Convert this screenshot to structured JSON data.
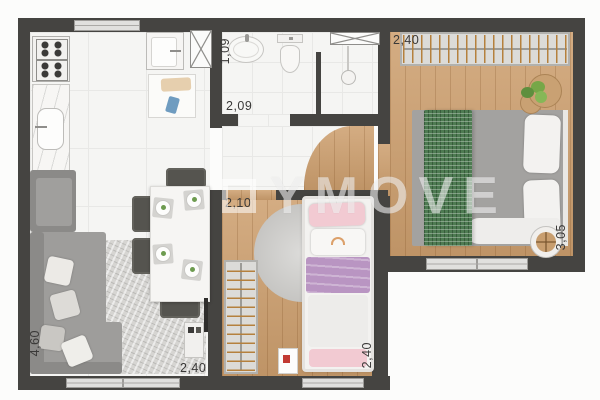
{
  "watermark": {
    "text": "YMOVE",
    "logo_icon": "square-outline-icon"
  },
  "labels": {
    "bedroom1_width": "2,40",
    "bedroom1_depth": "3,05",
    "bathroom_width": "1,09",
    "bathroom_depth": "2,09",
    "bedroom2_width": "2,10",
    "bedroom2_depth": "2,40",
    "living_depth": "4,60",
    "living_width": "2,40"
  },
  "colors": {
    "wall": "#454441",
    "tile_floor": "#f5f5f3",
    "wood_floor": "#cd9f6e",
    "sofa_gray": "#9e9d9b",
    "bed1_blanket_gray": "#a3a2a0",
    "bed1_throw_green": "#4e7b52",
    "bed2_blanket_lilac": "#b995c2",
    "bed2_pillow_pink": "#f2cad2",
    "hanger_wood": "#b5803d",
    "dimension_text": "#3a3938"
  },
  "rooms": {
    "kitchen_service": [
      "stove",
      "counter-with-sink",
      "laundry-tank",
      "laundry-counter",
      "duct-shaft",
      "window"
    ],
    "bathroom": [
      "washbasin",
      "toilet",
      "shower-head",
      "duct-shaft"
    ],
    "bedroom1": [
      "wardrobe-hangers",
      "double-bed",
      "plant",
      "side-stool",
      "window"
    ],
    "bedroom2": [
      "wardrobe-hangers",
      "single-bed",
      "round-rug",
      "toy-box",
      "window"
    ],
    "living_dining": [
      "corner-sofa",
      "sofa-cushions",
      "area-rug",
      "dining-table",
      "dining-chairs",
      "tv-console",
      "tv-panel",
      "sliding-window"
    ]
  }
}
